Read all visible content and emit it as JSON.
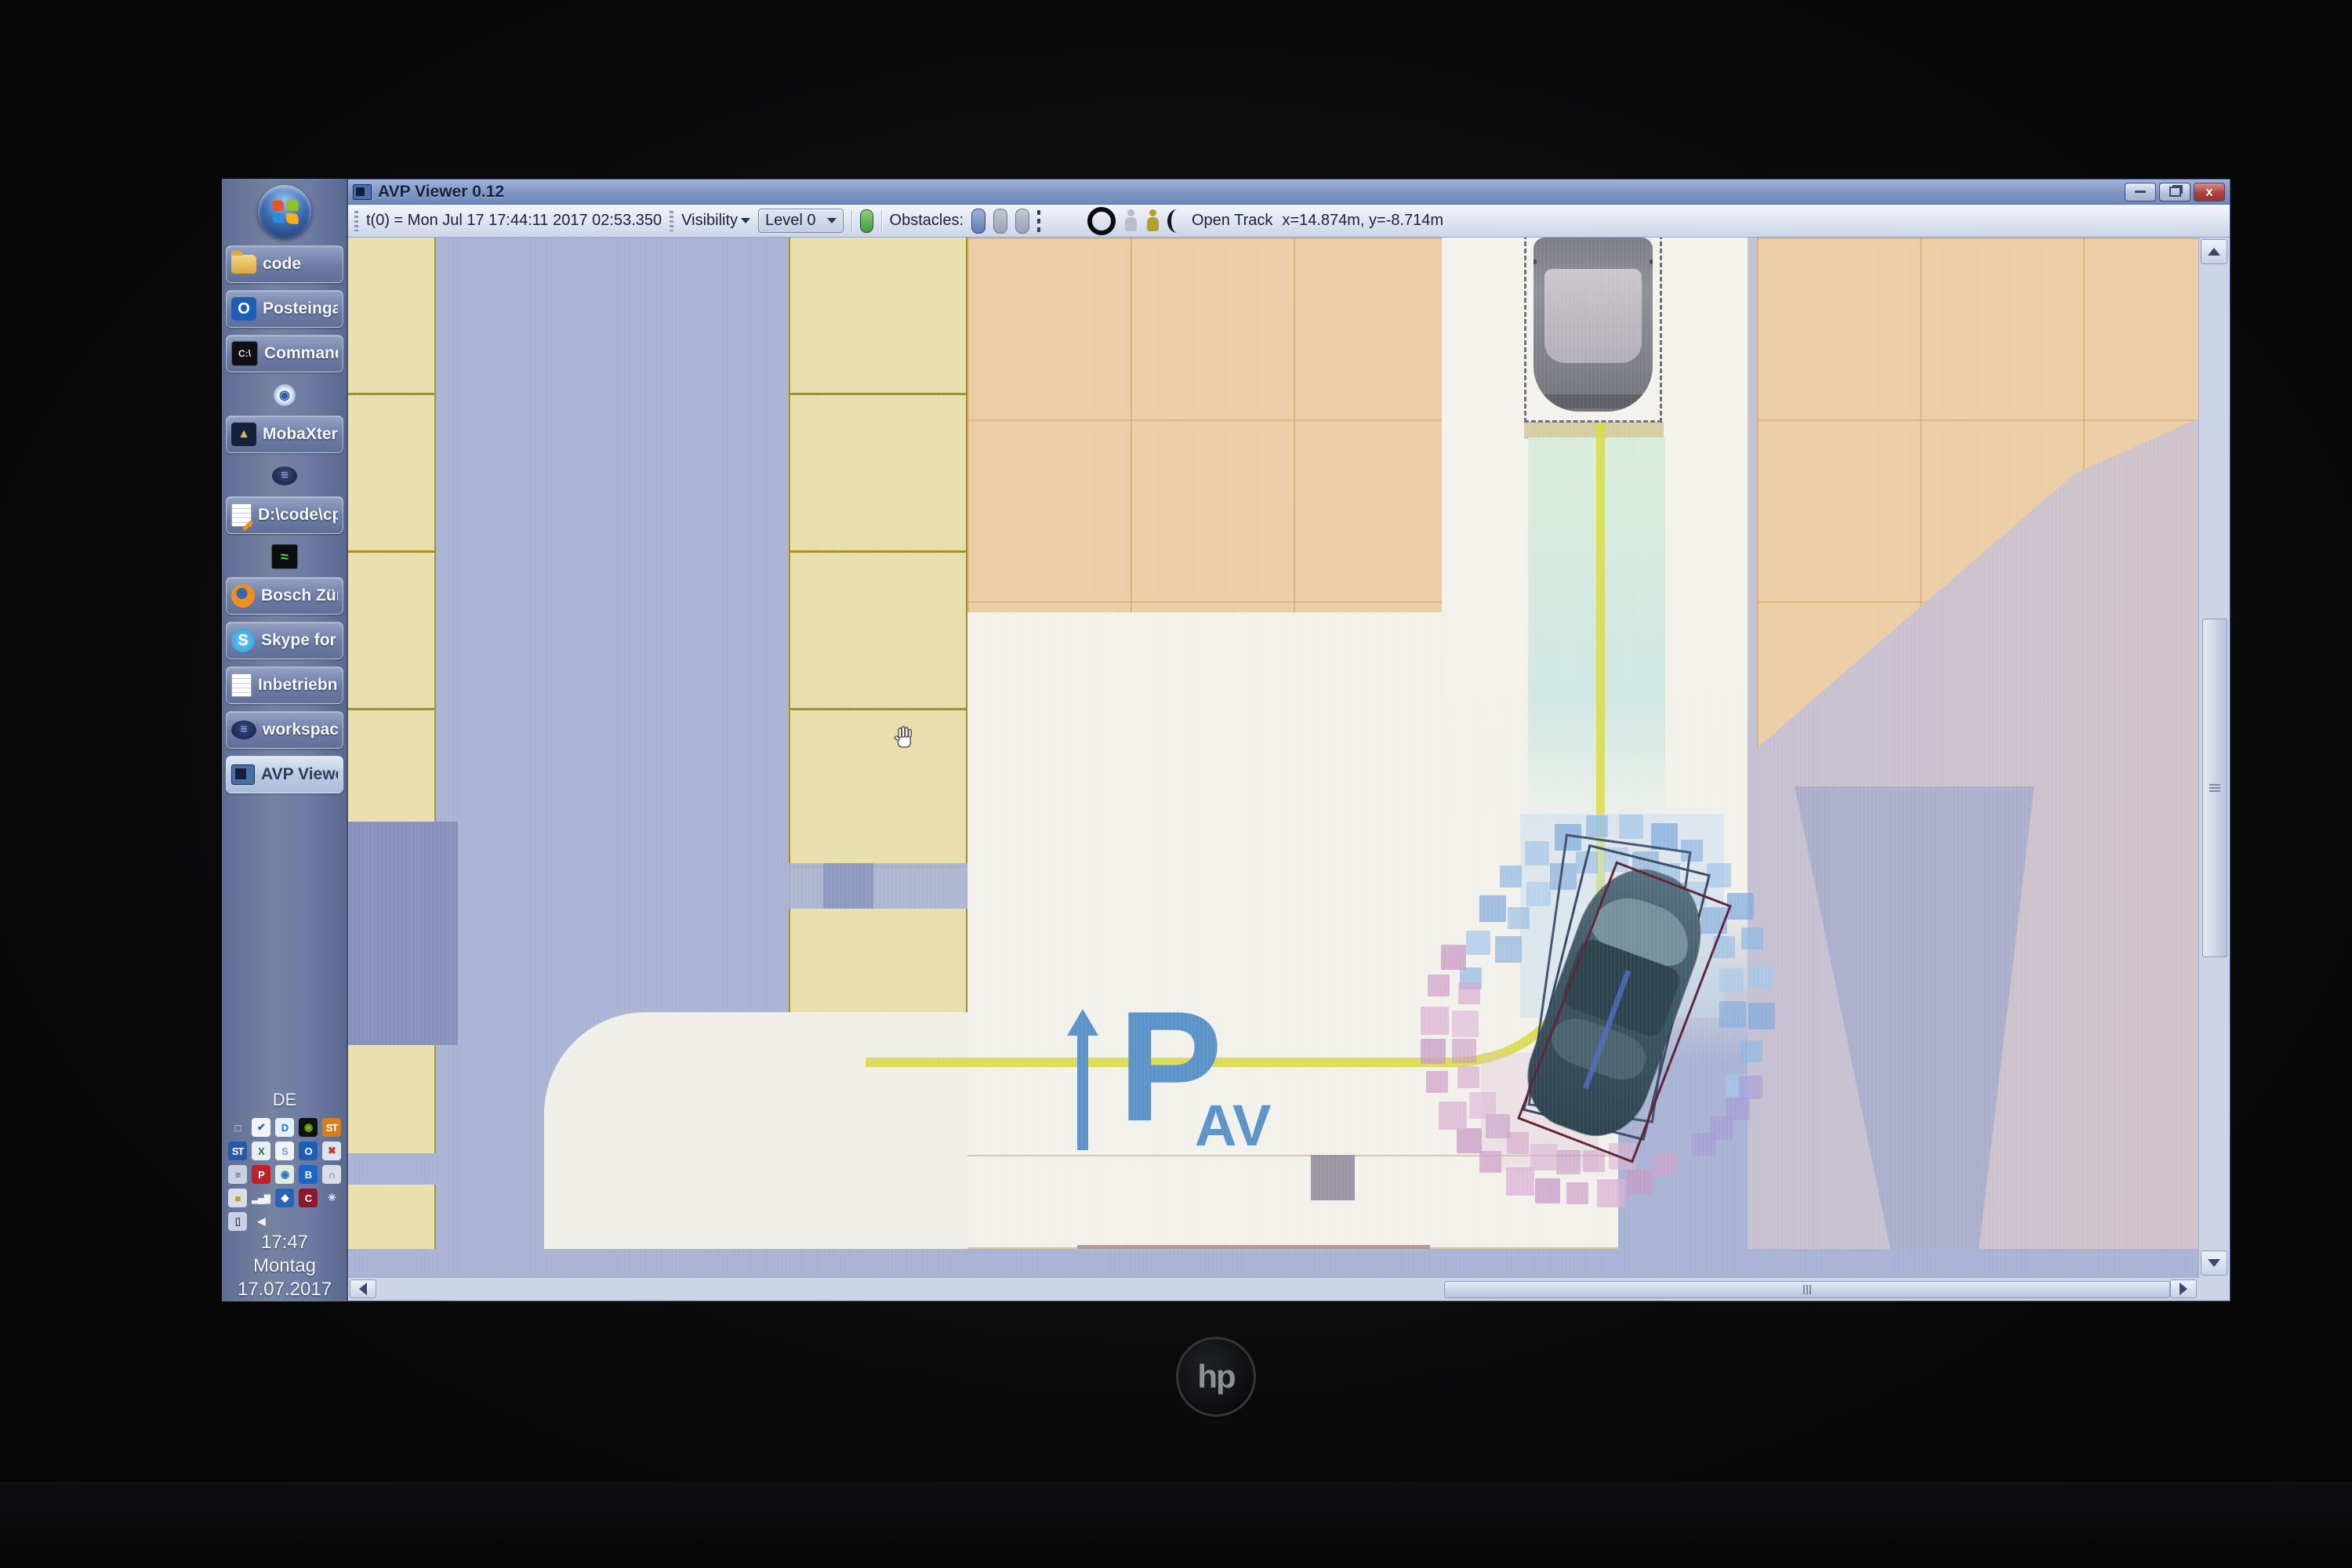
{
  "desktop": {
    "laptop_brand": "hp",
    "language_indicator": "DE",
    "clock": {
      "time": "17:47",
      "weekday": "Montag",
      "date": "17.07.2017"
    },
    "taskbar_items": [
      {
        "label": "code",
        "icon": "folder-icon",
        "type": "labeled"
      },
      {
        "label": "Posteingang - ...",
        "icon": "outlook-icon",
        "type": "labeled"
      },
      {
        "label": "Command Pr...",
        "icon": "command-prompt-icon",
        "type": "labeled"
      },
      {
        "label": "",
        "icon": "app-loading-icon",
        "type": "icon-only"
      },
      {
        "label": "MobaXterm",
        "icon": "mobaxterm-icon",
        "type": "labeled"
      },
      {
        "label": "",
        "icon": "eclipse-icon",
        "type": "icon-only"
      },
      {
        "label": "D:\\code\\cp.av...",
        "icon": "notepad-edit-icon",
        "type": "labeled"
      },
      {
        "label": "",
        "icon": "system-monitor-icon",
        "type": "icon-only"
      },
      {
        "label": "Bosch Zünder ...",
        "icon": "firefox-icon",
        "type": "labeled"
      },
      {
        "label": "Skype for Busi...",
        "icon": "skype-icon",
        "type": "labeled"
      },
      {
        "label": "Inbetriebnah...",
        "icon": "notepad-icon",
        "type": "labeled"
      },
      {
        "label": "workspace - P...",
        "icon": "eclipse-icon",
        "type": "labeled"
      },
      {
        "label": "AVP Viewer 0.12",
        "icon": "avp-viewer-icon",
        "type": "labeled",
        "active": true
      }
    ],
    "tray_icons": [
      {
        "name": "display-settings-icon",
        "glyph": "□",
        "bg": "transparent",
        "fg": "#e8ecf4"
      },
      {
        "name": "antivirus-check-icon",
        "glyph": "✔",
        "bg": "#f2f4f8",
        "fg": "#2a5fc4"
      },
      {
        "name": "sync-app-icon",
        "glyph": "D",
        "bg": "#e6f0fa",
        "fg": "#1f78c8"
      },
      {
        "name": "nvidia-icon",
        "glyph": "◉",
        "bg": "#101010",
        "fg": "#76b900"
      },
      {
        "name": "st-orange-icon",
        "glyph": "ST",
        "bg": "#d88018",
        "fg": "#ffffff"
      },
      {
        "name": "st-blue-icon",
        "glyph": "ST",
        "bg": "#2858a8",
        "fg": "#ffffff"
      },
      {
        "name": "spreadsheet-icon",
        "glyph": "X",
        "bg": "#e8eef6",
        "fg": "#1f6e43"
      },
      {
        "name": "skype-offline-icon",
        "glyph": "S",
        "bg": "#eef4fa",
        "fg": "#6d9fc4"
      },
      {
        "name": "outlook-tray-icon",
        "glyph": "O",
        "bg": "#1e5fb4",
        "fg": "#ffffff"
      },
      {
        "name": "contacts-unavailable-icon",
        "glyph": "✖",
        "bg": "#dde4ee",
        "fg": "#c23b2e"
      },
      {
        "name": "network-tree-icon",
        "glyph": "≡",
        "bg": "#c9d2e2",
        "fg": "#4a5a74"
      },
      {
        "name": "pulse-secure-icon",
        "glyph": "P",
        "bg": "#c02028",
        "fg": "#ffffff"
      },
      {
        "name": "globe-sync-icon",
        "glyph": "◉",
        "bg": "#ddeee0",
        "fg": "#2f6fbe"
      },
      {
        "name": "bluetooth-icon",
        "glyph": "B",
        "bg": "#1a66c8",
        "fg": "#ffffff"
      },
      {
        "name": "headset-muted-icon",
        "glyph": "∩",
        "bg": "#d8dde8",
        "fg": "#5a6270"
      },
      {
        "name": "credential-lock-icon",
        "glyph": "■",
        "bg": "#d8dde8",
        "fg": "#c8a018"
      },
      {
        "name": "signal-strength-icon",
        "glyph": "▂▄▆",
        "bg": "transparent",
        "fg": "#f0f2f6"
      },
      {
        "name": "network-mesh-icon",
        "glyph": "◆",
        "bg": "#2a62b8",
        "fg": "#ffffff"
      },
      {
        "name": "trend-micro-icon",
        "glyph": "C",
        "bg": "#8c1830",
        "fg": "#ffffff"
      },
      {
        "name": "snowflake-icon",
        "glyph": "✳",
        "bg": "transparent",
        "fg": "#dfe6f2"
      },
      {
        "name": "phone-icon",
        "glyph": "▯",
        "bg": "#c9d2e2",
        "fg": "#3c4a66"
      },
      {
        "name": "volume-icon",
        "glyph": "◀",
        "bg": "transparent",
        "fg": "#f0f2f6"
      }
    ]
  },
  "window": {
    "title": "AVP Viewer 0.12",
    "controls": {
      "close_glyph": "x"
    },
    "toolbar": {
      "timestamp": "t(0) = Mon Jul 17 17:44:11 2017  02:53.350",
      "visibility_label": "Visibility",
      "level_dropdown": "Level 0",
      "obstacles_label": "Obstacles:",
      "open_track_label": "Open Track",
      "coordinates": "x=14.874m, y=-8.714m"
    }
  },
  "map": {
    "parking_logo": {
      "p": "P",
      "sub": "AV"
    },
    "colors": {
      "road": "#a9b3d3",
      "stall_yellow": "#e8dfad",
      "stall_border_yellow": "#a39022",
      "stall_tan": "#ebcda6",
      "apron_white": "#f2f0ea",
      "path_yellow": "#d9da45",
      "occupancy_blue": "#8fb9e3",
      "occupancy_pink": "#d2a3cb",
      "occupancy_purple": "#a79bd6",
      "planned_spot_mint": "#d9ecdc",
      "ego_car_teal": "#3c5662",
      "parked_van_gray": "#8f8f97",
      "logo_blue": "#5b93c8",
      "titlebar_blue": "#7e96c4",
      "taskbar_blue": "#6d7ca4",
      "close_red": "#b04040"
    }
  }
}
